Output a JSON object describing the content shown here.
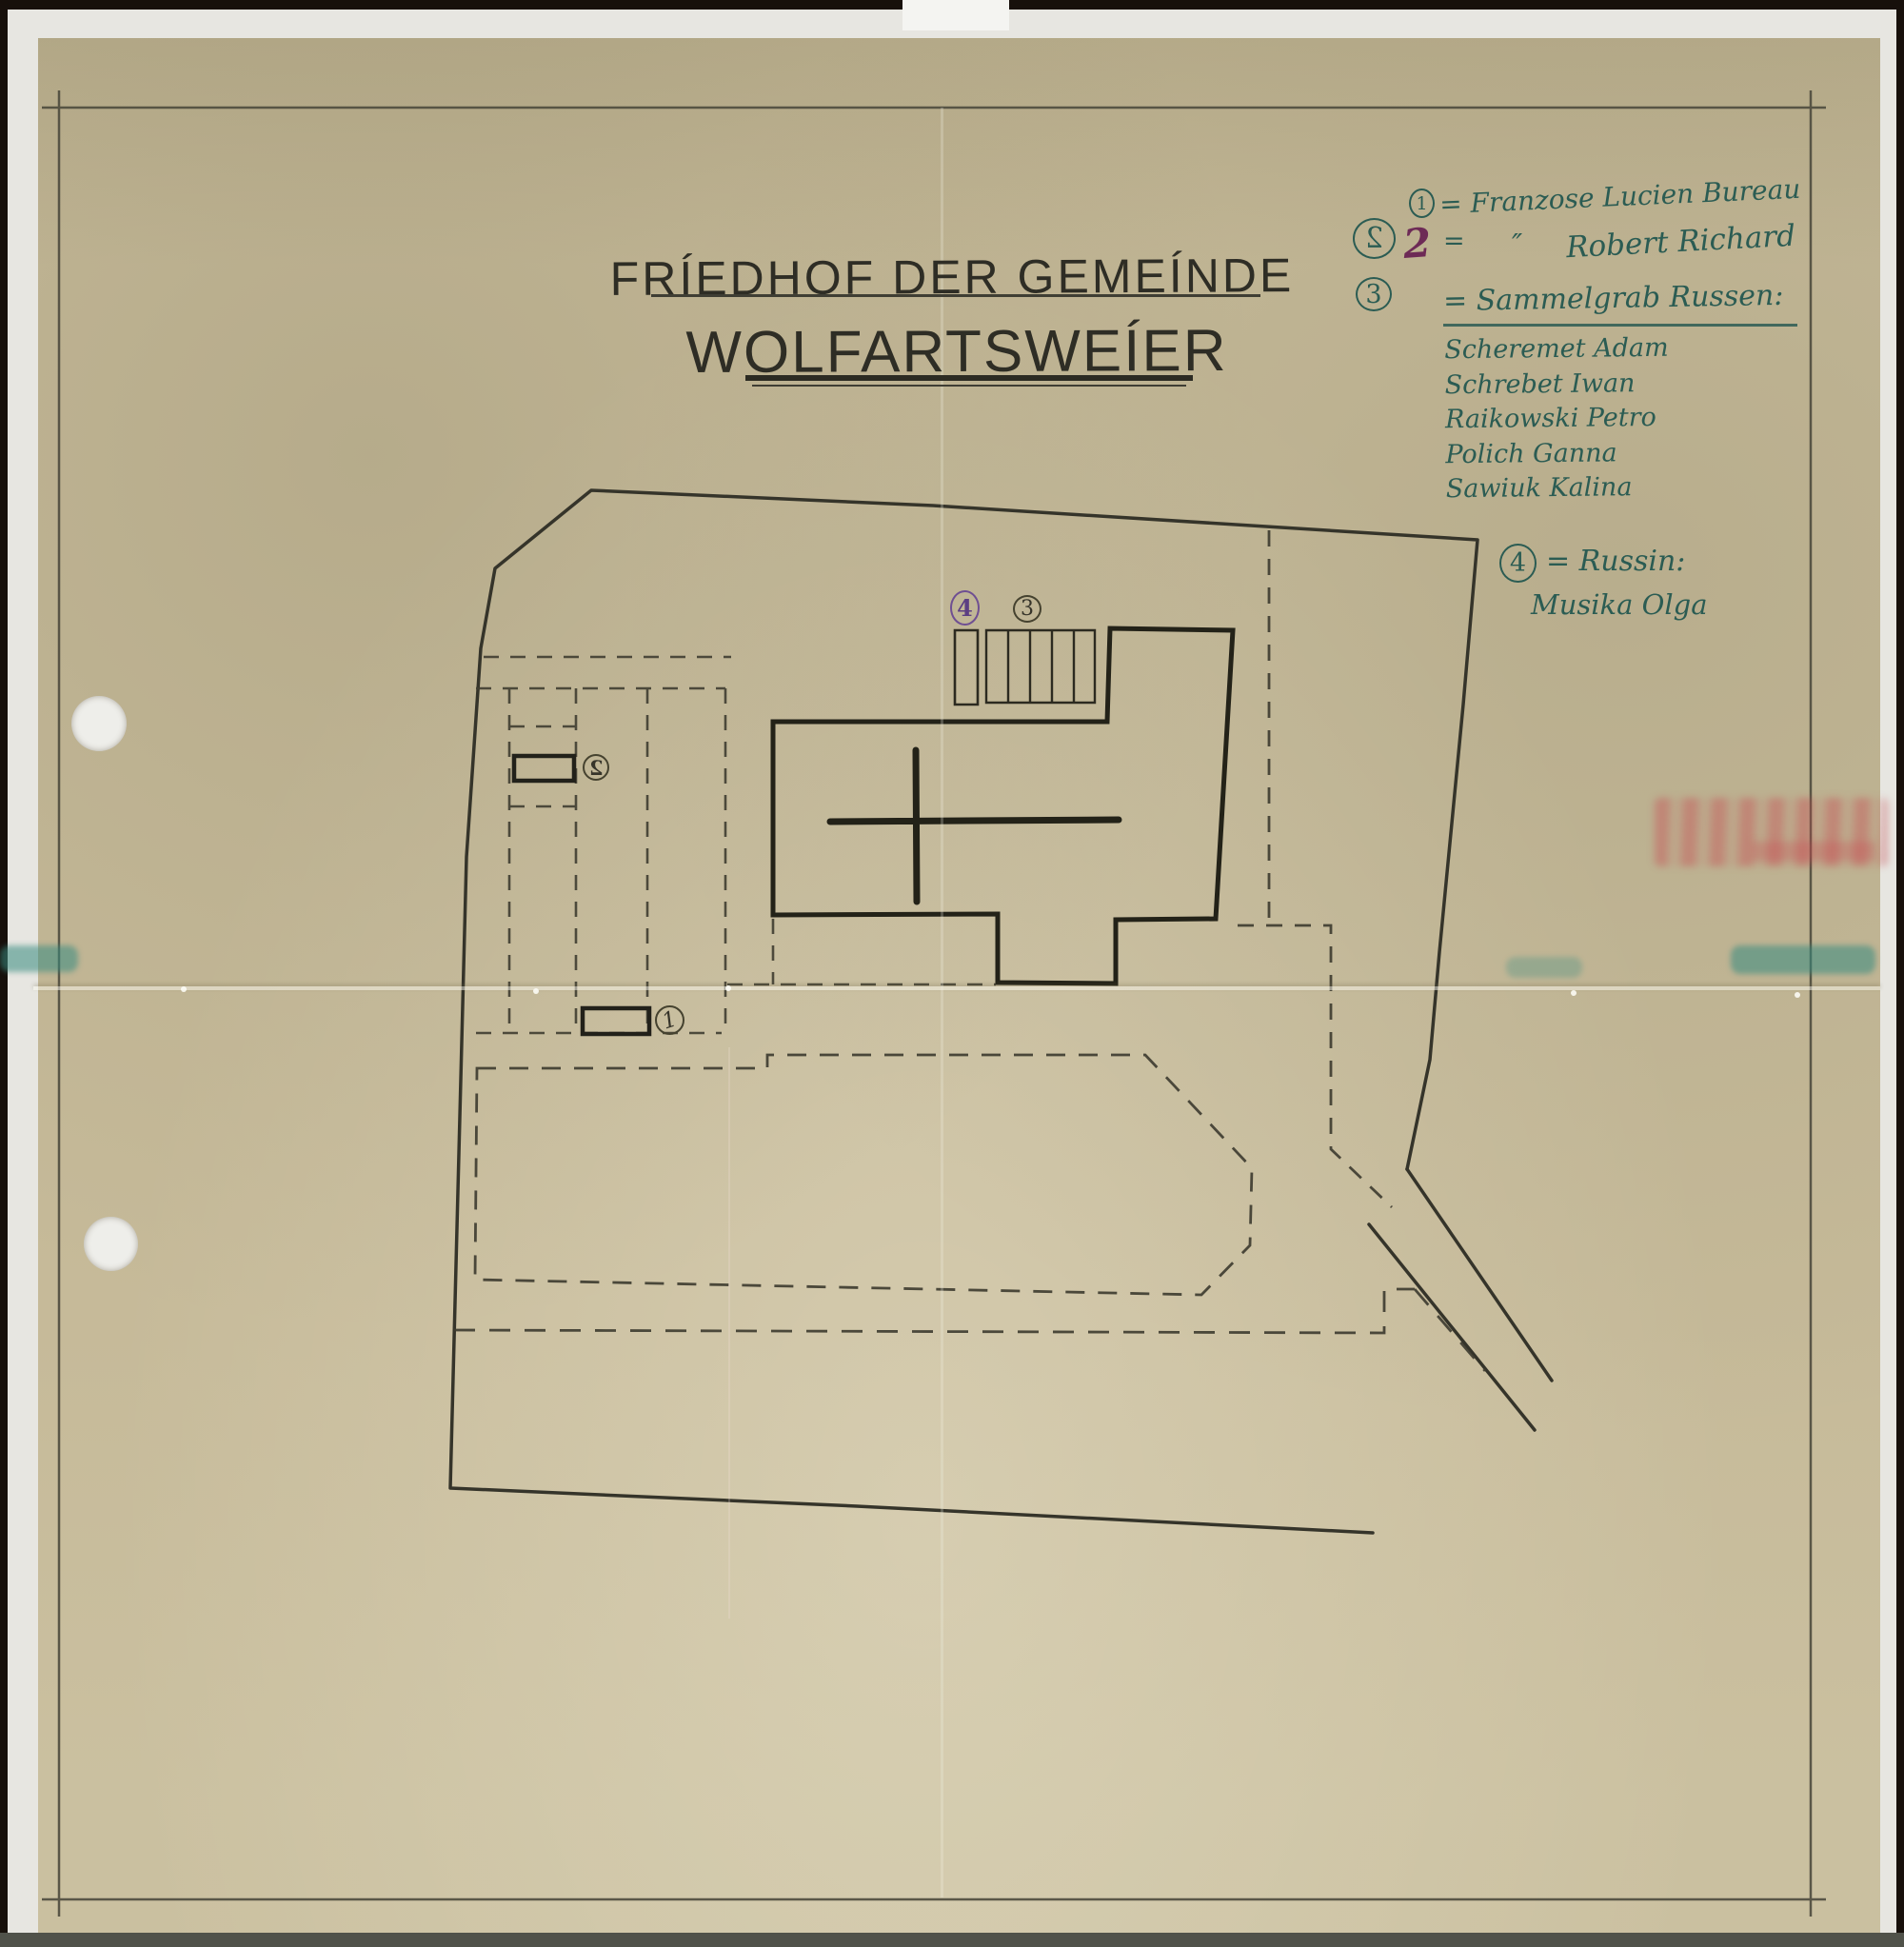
{
  "title": {
    "line1": "FRÍEDHOF DER GEMEÍNDE",
    "line2": "WOLFARTSWEÍER"
  },
  "legend": {
    "row1": {
      "num": "1",
      "text": "= Franzose Lucien Bureau"
    },
    "row2": {
      "num": "2",
      "overwrite": "2",
      "eq": "=",
      "ditto": "″",
      "name": "Robert Richard"
    },
    "row3": {
      "num": "3",
      "text": "= Sammelgrab Russen:"
    },
    "names": [
      "Scheremet Adam",
      "Schrebet Iwan",
      "Raikowski Petro",
      "Polich Ganna",
      "Sawiuk Kalina"
    ],
    "row4": {
      "num": "4",
      "text": "= Russin:",
      "name": "Musika Olga"
    }
  },
  "plan": {
    "marker1": "1",
    "marker2": "2",
    "marker3": "3",
    "marker4": "4"
  },
  "colors": {
    "paper": "#c6ba99",
    "pencil": "#3f3d31",
    "building_ink": "#232218",
    "legend_ink": "#2b5c53",
    "marker4_ink": "#6f4f92",
    "overwrite_ink": "#6d2a56",
    "stamp_red": "#c64850",
    "teal_stain": "#378a80"
  }
}
